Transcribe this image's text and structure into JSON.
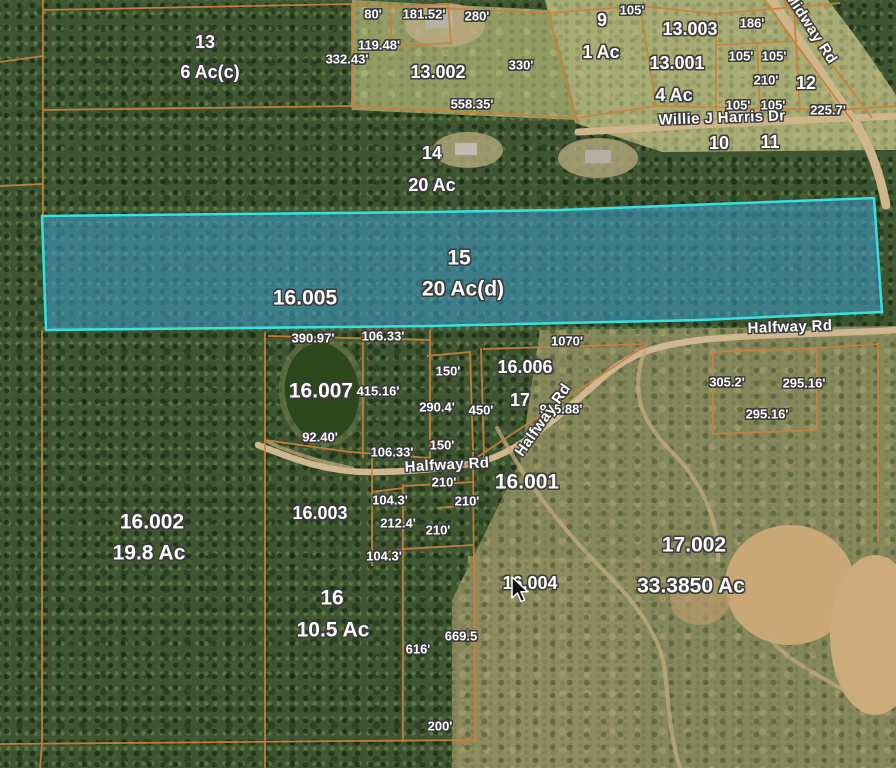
{
  "map": {
    "highlight": {
      "parcel_number": "15",
      "acreage": "20 Ac(d)",
      "related_id": "16.005",
      "fill_color": "#3c9fd0",
      "border_color": "#38e0e0"
    },
    "colors": {
      "parcel_line": "#c8813c",
      "label_text": "#ffffff",
      "label_outline": "#3c3c3c",
      "road_fill": "#cfb78f",
      "pond_fill": "#2c4719"
    },
    "labels": [
      {
        "name": "parcel-label-13",
        "text": "13",
        "x": 205,
        "y": 42,
        "size": "lg"
      },
      {
        "name": "acreage-label-13",
        "text": "6 Ac(c)",
        "x": 210,
        "y": 72,
        "size": "lg"
      },
      {
        "name": "parcel-label-13-002",
        "text": "13.002",
        "x": 438,
        "y": 72,
        "size": "lg"
      },
      {
        "name": "parcel-label-9",
        "text": "9",
        "x": 602,
        "y": 20,
        "size": "lg"
      },
      {
        "name": "acreage-label-9",
        "text": "1 Ac",
        "x": 601,
        "y": 52,
        "size": "lg"
      },
      {
        "name": "parcel-label-13-003",
        "text": "13.003",
        "x": 690,
        "y": 29,
        "size": "lg"
      },
      {
        "name": "parcel-label-13-001",
        "text": "13.001",
        "x": 677,
        "y": 63,
        "size": "lg"
      },
      {
        "name": "acreage-label-13-001",
        "text": "4 Ac",
        "x": 674,
        "y": 95,
        "size": "lg"
      },
      {
        "name": "parcel-label-12",
        "text": "12",
        "x": 806,
        "y": 83,
        "size": "lg"
      },
      {
        "name": "parcel-label-10",
        "text": "10",
        "x": 719,
        "y": 143,
        "size": "lg"
      },
      {
        "name": "parcel-label-11",
        "text": "11",
        "x": 770,
        "y": 142,
        "size": "lg"
      },
      {
        "name": "parcel-label-14",
        "text": "14",
        "x": 432,
        "y": 153,
        "size": "lg"
      },
      {
        "name": "acreage-label-14",
        "text": "20 Ac",
        "x": 432,
        "y": 185,
        "size": "lg"
      },
      {
        "name": "parcel-label-15",
        "text": "15",
        "x": 459,
        "y": 258,
        "size": "xl"
      },
      {
        "name": "acreage-label-15",
        "text": "20 Ac(d)",
        "x": 463,
        "y": 289,
        "size": "xl"
      },
      {
        "name": "parcel-label-16-005",
        "text": "16.005",
        "x": 305,
        "y": 298,
        "size": "xl"
      },
      {
        "name": "parcel-label-16-007",
        "text": "16.007",
        "x": 321,
        "y": 391,
        "size": "xl"
      },
      {
        "name": "parcel-label-16-006",
        "text": "16.006",
        "x": 525,
        "y": 367,
        "size": "lg"
      },
      {
        "name": "parcel-label-17",
        "text": "17",
        "x": 520,
        "y": 400,
        "size": "lg"
      },
      {
        "name": "parcel-label-16-001",
        "text": "16.001",
        "x": 527,
        "y": 482,
        "size": "xl"
      },
      {
        "name": "parcel-label-16-002",
        "text": "16.002",
        "x": 152,
        "y": 522,
        "size": "xl"
      },
      {
        "name": "acreage-label-16-002",
        "text": "19.8 Ac",
        "x": 149,
        "y": 553,
        "size": "xl"
      },
      {
        "name": "parcel-label-16-003",
        "text": "16.003",
        "x": 320,
        "y": 513,
        "size": "lg"
      },
      {
        "name": "parcel-label-16",
        "text": "16",
        "x": 332,
        "y": 598,
        "size": "xl"
      },
      {
        "name": "acreage-label-16",
        "text": "10.5 Ac",
        "x": 333,
        "y": 630,
        "size": "xl"
      },
      {
        "name": "parcel-label-16-004",
        "text": "16.004",
        "x": 530,
        "y": 583,
        "size": "lg"
      },
      {
        "name": "parcel-label-17-002",
        "text": "17.002",
        "x": 694,
        "y": 545,
        "size": "xl"
      },
      {
        "name": "acreage-label-17-002",
        "text": "33.3850 Ac",
        "x": 691,
        "y": 586,
        "size": "xl"
      },
      {
        "name": "measurement-80ft",
        "text": "80'",
        "x": 373,
        "y": 14,
        "size": "sm"
      },
      {
        "name": "measurement-181-52ft",
        "text": "181.52'",
        "x": 424,
        "y": 14,
        "size": "sm"
      },
      {
        "name": "measurement-280ft",
        "text": "280'",
        "x": 477,
        "y": 16,
        "size": "sm"
      },
      {
        "name": "measurement-119-48ft",
        "text": "119.48'",
        "x": 379,
        "y": 45,
        "size": "sm"
      },
      {
        "name": "measurement-332-43ft",
        "text": "332.43'",
        "x": 347,
        "y": 59,
        "size": "sm"
      },
      {
        "name": "measurement-330ft",
        "text": "330'",
        "x": 521,
        "y": 65,
        "size": "sm"
      },
      {
        "name": "measurement-558-35ft",
        "text": "558.35'",
        "x": 472,
        "y": 104,
        "size": "sm"
      },
      {
        "name": "measurement-105ft-a",
        "text": "105'",
        "x": 632,
        "y": 10,
        "size": "sm"
      },
      {
        "name": "measurement-186ft",
        "text": "186'",
        "x": 752,
        "y": 23,
        "size": "sm"
      },
      {
        "name": "measurement-105ft-b",
        "text": "105'",
        "x": 741,
        "y": 56,
        "size": "sm"
      },
      {
        "name": "measurement-105ft-c",
        "text": "105'",
        "x": 774,
        "y": 56,
        "size": "sm"
      },
      {
        "name": "measurement-210ft-a",
        "text": "210'",
        "x": 766,
        "y": 80,
        "size": "sm"
      },
      {
        "name": "measurement-105ft-d",
        "text": "105'",
        "x": 738,
        "y": 105,
        "size": "sm"
      },
      {
        "name": "measurement-105ft-e",
        "text": "105'",
        "x": 773,
        "y": 105,
        "size": "sm"
      },
      {
        "name": "measurement-225-7ft",
        "text": "225.7'",
        "x": 828,
        "y": 110,
        "size": "sm"
      },
      {
        "name": "measurement-1070ft",
        "text": "1070'",
        "x": 567,
        "y": 341,
        "size": "sm"
      },
      {
        "name": "measurement-390-97ft",
        "text": "390.97'",
        "x": 313,
        "y": 338,
        "size": "sm"
      },
      {
        "name": "measurement-106-33ft-a",
        "text": "106.33'",
        "x": 383,
        "y": 336,
        "size": "sm"
      },
      {
        "name": "measurement-415-16ft",
        "text": "415.16'",
        "x": 378,
        "y": 391,
        "size": "sm"
      },
      {
        "name": "measurement-150ft-a",
        "text": "150'",
        "x": 448,
        "y": 371,
        "size": "sm"
      },
      {
        "name": "measurement-290-4ft",
        "text": "290.4'",
        "x": 437,
        "y": 407,
        "size": "sm"
      },
      {
        "name": "measurement-450ft",
        "text": "450'",
        "x": 481,
        "y": 410,
        "size": "sm"
      },
      {
        "name": "measurement-925-88ft",
        "text": "925.88'",
        "x": 561,
        "y": 409,
        "size": "sm"
      },
      {
        "name": "measurement-305-2ft",
        "text": "305.2'",
        "x": 727,
        "y": 382,
        "size": "sm"
      },
      {
        "name": "measurement-295-16ft-a",
        "text": "295.16'",
        "x": 804,
        "y": 383,
        "size": "sm"
      },
      {
        "name": "measurement-295-16ft-b",
        "text": "295.16'",
        "x": 767,
        "y": 414,
        "size": "sm"
      },
      {
        "name": "measurement-92-40ft",
        "text": "92.40'",
        "x": 320,
        "y": 437,
        "size": "sm"
      },
      {
        "name": "measurement-106-33ft-b",
        "text": "106.33'",
        "x": 392,
        "y": 452,
        "size": "sm"
      },
      {
        "name": "measurement-150ft-b",
        "text": "150'",
        "x": 442,
        "y": 445,
        "size": "sm"
      },
      {
        "name": "measurement-210ft-b",
        "text": "210'",
        "x": 444,
        "y": 482,
        "size": "sm"
      },
      {
        "name": "measurement-104-3ft-a",
        "text": "104.3'",
        "x": 390,
        "y": 500,
        "size": "sm"
      },
      {
        "name": "measurement-210ft-c",
        "text": "210'",
        "x": 467,
        "y": 501,
        "size": "sm"
      },
      {
        "name": "measurement-212-4ft",
        "text": "212.4'",
        "x": 398,
        "y": 523,
        "size": "sm"
      },
      {
        "name": "measurement-210ft-d",
        "text": "210'",
        "x": 438,
        "y": 530,
        "size": "sm"
      },
      {
        "name": "measurement-104-3ft-b",
        "text": "104.3'",
        "x": 384,
        "y": 556,
        "size": "sm"
      },
      {
        "name": "measurement-669-5",
        "text": "669.5",
        "x": 461,
        "y": 636,
        "size": "sm"
      },
      {
        "name": "measurement-616ft",
        "text": "616'",
        "x": 418,
        "y": 649,
        "size": "sm"
      },
      {
        "name": "measurement-200ft",
        "text": "200'",
        "x": 440,
        "y": 726,
        "size": "sm"
      },
      {
        "name": "road-label-midway-rd",
        "text": "Midway Rd",
        "x": 811,
        "y": 28,
        "size": "rd",
        "rot": 57
      },
      {
        "name": "road-label-willie-j-harris-dr",
        "text": "Willie J Harris Dr",
        "x": 722,
        "y": 118,
        "size": "rd",
        "rot": -2
      },
      {
        "name": "road-label-halfway-rd-east",
        "text": "Halfway Rd",
        "x": 790,
        "y": 327,
        "size": "rd",
        "rot": -2
      },
      {
        "name": "road-label-halfway-rd-diagonal",
        "text": "Halfway Rd",
        "x": 543,
        "y": 420,
        "size": "rd",
        "rot": -55
      },
      {
        "name": "road-label-halfway-rd-west",
        "text": "Halfway Rd",
        "x": 447,
        "y": 465,
        "size": "rd",
        "rot": -3
      }
    ]
  }
}
